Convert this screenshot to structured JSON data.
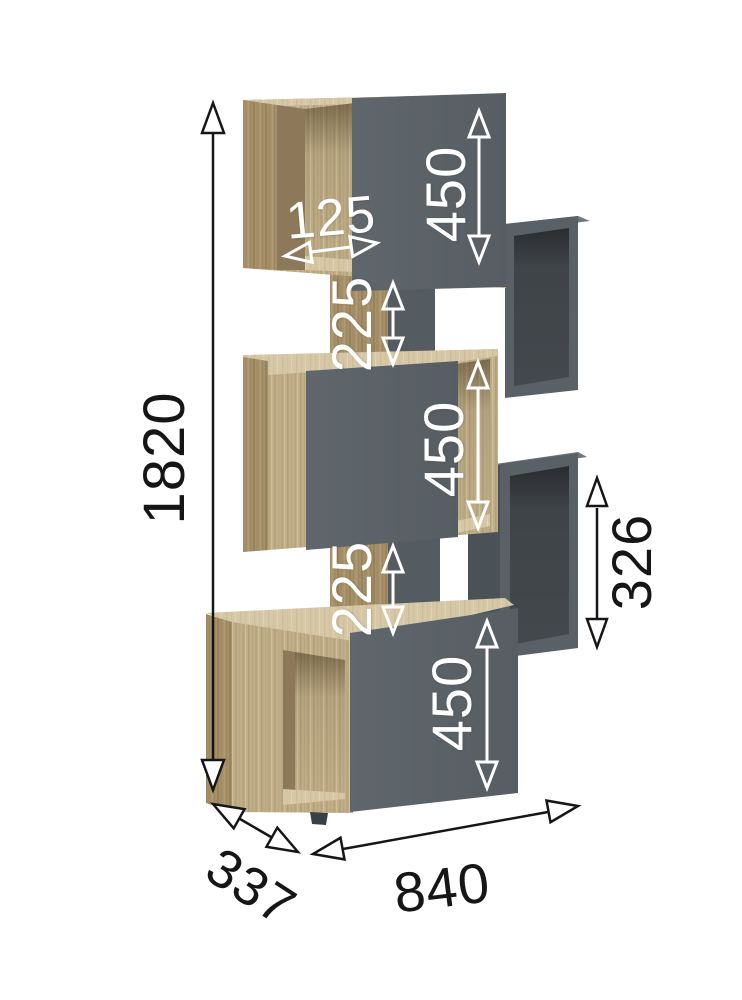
{
  "diagram": {
    "kind": "furniture-dimension-diagram",
    "subject": "modular staircase shelving unit with oak frame and graphite doors",
    "unit_system": "mm",
    "labels": {
      "overall_height": "1820",
      "overall_width": "840",
      "overall_depth": "337",
      "top_door_height": "450",
      "middle_door_height": "450",
      "bottom_door_height": "450",
      "upper_gap_height": "225",
      "lower_gap_height": "225",
      "top_niche_width": "125",
      "side_cube_height": "326"
    },
    "colors": {
      "background": "#ffffff",
      "wood_mid": "#c0ae89",
      "wood_dark": "#a6906a",
      "wood_light": "#d6c8a6",
      "door_gray": "#5a6166",
      "cube_interior_gray": "#43484d",
      "dimension_black": "#161616",
      "dimension_white": "#ffffff"
    }
  }
}
